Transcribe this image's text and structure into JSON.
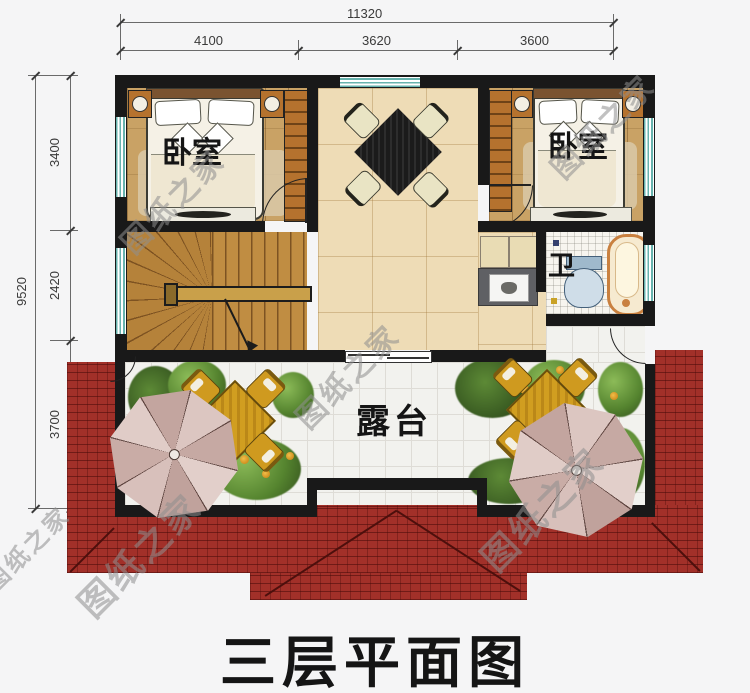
{
  "title": "三层平面图",
  "watermark": "图纸之家",
  "dims": {
    "top_total": "11320",
    "top_segs": [
      "4100",
      "3620",
      "3600"
    ],
    "left_total": "9520",
    "left_segs": [
      "3400",
      "2420",
      "3700"
    ]
  },
  "rooms": {
    "bedroom_left": "卧室",
    "bedroom_right": "卧室",
    "bath": "卫",
    "terrace": "露台"
  },
  "colors": {
    "roof": "#a23029",
    "wall": "#191919",
    "window": "#67b3ae",
    "bedroom_floor": "#c9a265",
    "hall_floor": "#eedcb6",
    "patio_gold": "#cf9a1f",
    "umbrella": "#d8c0bb"
  }
}
